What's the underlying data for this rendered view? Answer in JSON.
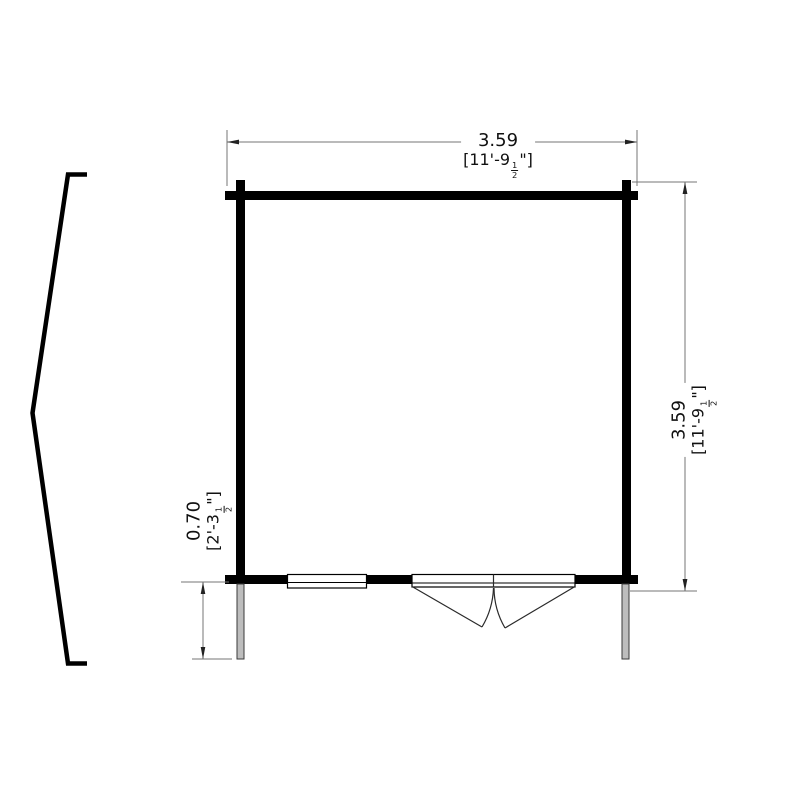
{
  "drawing": {
    "type": "log-cabin-floor-plan",
    "dimensions": {
      "width": {
        "metric": "3.59",
        "imperial_pre": "[11'-9",
        "frac_num": "1",
        "frac_den": "2",
        "imperial_post": "\"]"
      },
      "depth": {
        "metric": "3.59",
        "imperial_pre": "[11'-9",
        "frac_num": "1",
        "frac_den": "2",
        "imperial_post": "\"]"
      },
      "canopy_depth": {
        "metric": "0.70",
        "imperial_pre": "[2'-3",
        "frac_num": "1",
        "frac_den": "2",
        "imperial_post": "\"]"
      }
    },
    "features": {
      "window_count": 1,
      "door_type": "double-door"
    },
    "colors": {
      "wall": "#000000",
      "dimension_line": "#757575",
      "arrowhead": "#222222",
      "post_fill": "#bdbdbd",
      "text": "#111111",
      "background": "#ffffff"
    }
  }
}
